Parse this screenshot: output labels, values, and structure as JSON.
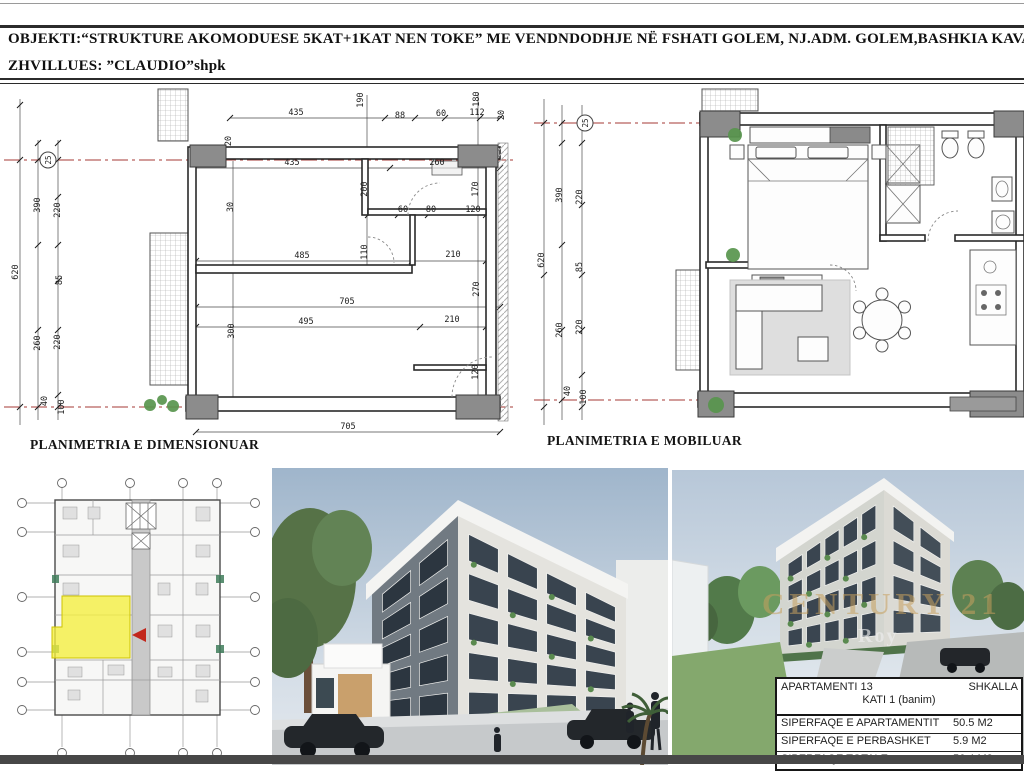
{
  "header": {
    "line1": "OBJEKTI:“STRUKTURE AKOMODUESE 5KAT+1KAT NEN TOKE” ME VENDNDODHJE NË FSHATI GOLEM, NJ.ADM. GOLEM,BASHKIA KAVAJE",
    "line2": "ZHVILLUES: ”CLAUDIO”shpk"
  },
  "plans": {
    "left": {
      "label": "PLANIMETRIA E DIMENSIONUAR",
      "axis_bubble": "25",
      "dims": [
        {
          "t": "435",
          "x": 296,
          "y": 30
        },
        {
          "t": "88",
          "x": 400,
          "y": 33
        },
        {
          "t": "60",
          "x": 441,
          "y": 31
        },
        {
          "t": "112",
          "x": 477,
          "y": 30
        },
        {
          "t": "435",
          "x": 292,
          "y": 80
        },
        {
          "t": "260",
          "x": 437,
          "y": 80
        },
        {
          "t": "60",
          "x": 403,
          "y": 127
        },
        {
          "t": "80",
          "x": 431,
          "y": 127
        },
        {
          "t": "120",
          "x": 473,
          "y": 127
        },
        {
          "t": "485",
          "x": 302,
          "y": 173
        },
        {
          "t": "210",
          "x": 453,
          "y": 172
        },
        {
          "t": "705",
          "x": 347,
          "y": 219
        },
        {
          "t": "495",
          "x": 306,
          "y": 239
        },
        {
          "t": "210",
          "x": 452,
          "y": 237
        },
        {
          "t": "705",
          "x": 348,
          "y": 344
        },
        {
          "t": "190",
          "x": 363,
          "y": 15,
          "r": -90
        },
        {
          "t": "180",
          "x": 479,
          "y": 14,
          "r": -90
        },
        {
          "t": "20",
          "x": 504,
          "y": 30,
          "r": -90
        },
        {
          "t": "20",
          "x": 231,
          "y": 56,
          "r": -90
        },
        {
          "t": "30",
          "x": 233,
          "y": 122,
          "r": -90
        },
        {
          "t": "200",
          "x": 367,
          "y": 104,
          "r": -90
        },
        {
          "t": "170",
          "x": 478,
          "y": 104,
          "r": -90
        },
        {
          "t": "110",
          "x": 367,
          "y": 167,
          "r": -90
        },
        {
          "t": "270",
          "x": 479,
          "y": 204,
          "r": -90
        },
        {
          "t": "300",
          "x": 234,
          "y": 246,
          "r": -90
        },
        {
          "t": "120",
          "x": 478,
          "y": 287,
          "r": -90
        },
        {
          "t": "620",
          "x": 18,
          "y": 187,
          "r": -90
        },
        {
          "t": "390",
          "x": 40,
          "y": 120,
          "r": -90
        },
        {
          "t": "220",
          "x": 60,
          "y": 125,
          "r": -90
        },
        {
          "t": "85",
          "x": 62,
          "y": 195,
          "r": -90
        },
        {
          "t": "260",
          "x": 40,
          "y": 258,
          "r": -90
        },
        {
          "t": "220",
          "x": 60,
          "y": 257,
          "r": -90
        },
        {
          "t": "40",
          "x": 47,
          "y": 316,
          "r": -90
        },
        {
          "t": "100",
          "x": 64,
          "y": 322,
          "r": -90
        }
      ]
    },
    "right": {
      "label": "PLANIMETRIA E MOBILUAR",
      "axis_bubble": "25",
      "dims": [
        {
          "t": "620",
          "x": 14,
          "y": 175,
          "r": -90
        },
        {
          "t": "390",
          "x": 32,
          "y": 110,
          "r": -90
        },
        {
          "t": "220",
          "x": 52,
          "y": 112,
          "r": -90
        },
        {
          "t": "85",
          "x": 52,
          "y": 182,
          "r": -90
        },
        {
          "t": "260",
          "x": 32,
          "y": 245,
          "r": -90
        },
        {
          "t": "220",
          "x": 52,
          "y": 242,
          "r": -90
        },
        {
          "t": "40",
          "x": 40,
          "y": 306,
          "r": -90
        },
        {
          "t": "100",
          "x": 56,
          "y": 312,
          "r": -90
        }
      ]
    }
  },
  "watermark": {
    "brand": "CENTURY 21",
    "sub": "Roy"
  },
  "summary_table": {
    "apartment": "APARTAMENTI 13",
    "stair": "SHKALLA",
    "floor": "KATI 1 (banim)",
    "rows": [
      {
        "label": "SIPERFAQE E APARTAMENTIT",
        "value": "50.5 M2"
      },
      {
        "label": "SIPERFAQE E PERBASHKET",
        "value": "5.9 M2"
      },
      {
        "label": "SIPERFAQE TOTALE",
        "value": "56.4 M2"
      }
    ]
  },
  "colors": {
    "accent_yellow": "#f5ef3d",
    "arrow_red": "#c2271c",
    "centerline_red": "#a63a35",
    "plant_green": "#58954d",
    "watermark_gold": "#c8a05e"
  }
}
